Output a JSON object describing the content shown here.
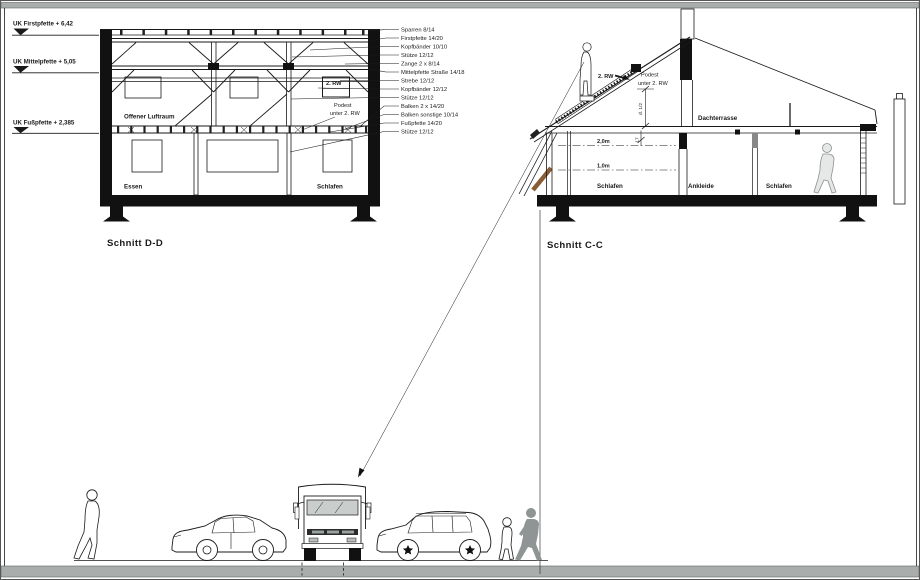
{
  "titles": {
    "schnitt_dd": "Schnitt D-D",
    "schnitt_cc": "Schnitt C-C"
  },
  "datums": [
    {
      "label": "UK Firstpfette  + 6,42"
    },
    {
      "label": "UK Mittelpfette + 5,05"
    },
    {
      "label": "UK Fußpfette  + 2,385"
    }
  ],
  "materials": [
    "Sparren 8/14",
    "Firstpfette 14/20",
    "Kopfbänder 10/10",
    "Stütze 12/12",
    "Zange 2 x 8/14",
    "Mittelpfette Straße 14/18",
    "Strebe 12/12",
    "Kopfbänder 12/12",
    "Stütze 12/12",
    "Balken 2 x 14/20",
    "Balken sonstige 10/14",
    "Fußpfette 14/20",
    "Stütze 12/12"
  ],
  "dd": {
    "offener_luftraum": "Offener Luftraum",
    "rw_box": "2. RW",
    "podest1": "Podest",
    "podest2": "unter 2. RW",
    "essen": "Essen",
    "schlafen": "Schlafen"
  },
  "cc": {
    "rw": "2. RW",
    "podest1": "Podest",
    "podest2": "unter 2. RW",
    "dachterrasse": "Dachterrasse",
    "h2": "2,0m",
    "h1": "1,0m",
    "schlafen_l": "Schlafen",
    "ankleide": "Ankleide",
    "schlafen_r": "Schlafen",
    "dim_roof": "d. 1/2",
    "dim_floor": "17"
  },
  "colors": {
    "wood": "#8a5c33",
    "bar": "#a9aeac",
    "silhouette": "#8f9594",
    "glass": "#c9cecd"
  }
}
